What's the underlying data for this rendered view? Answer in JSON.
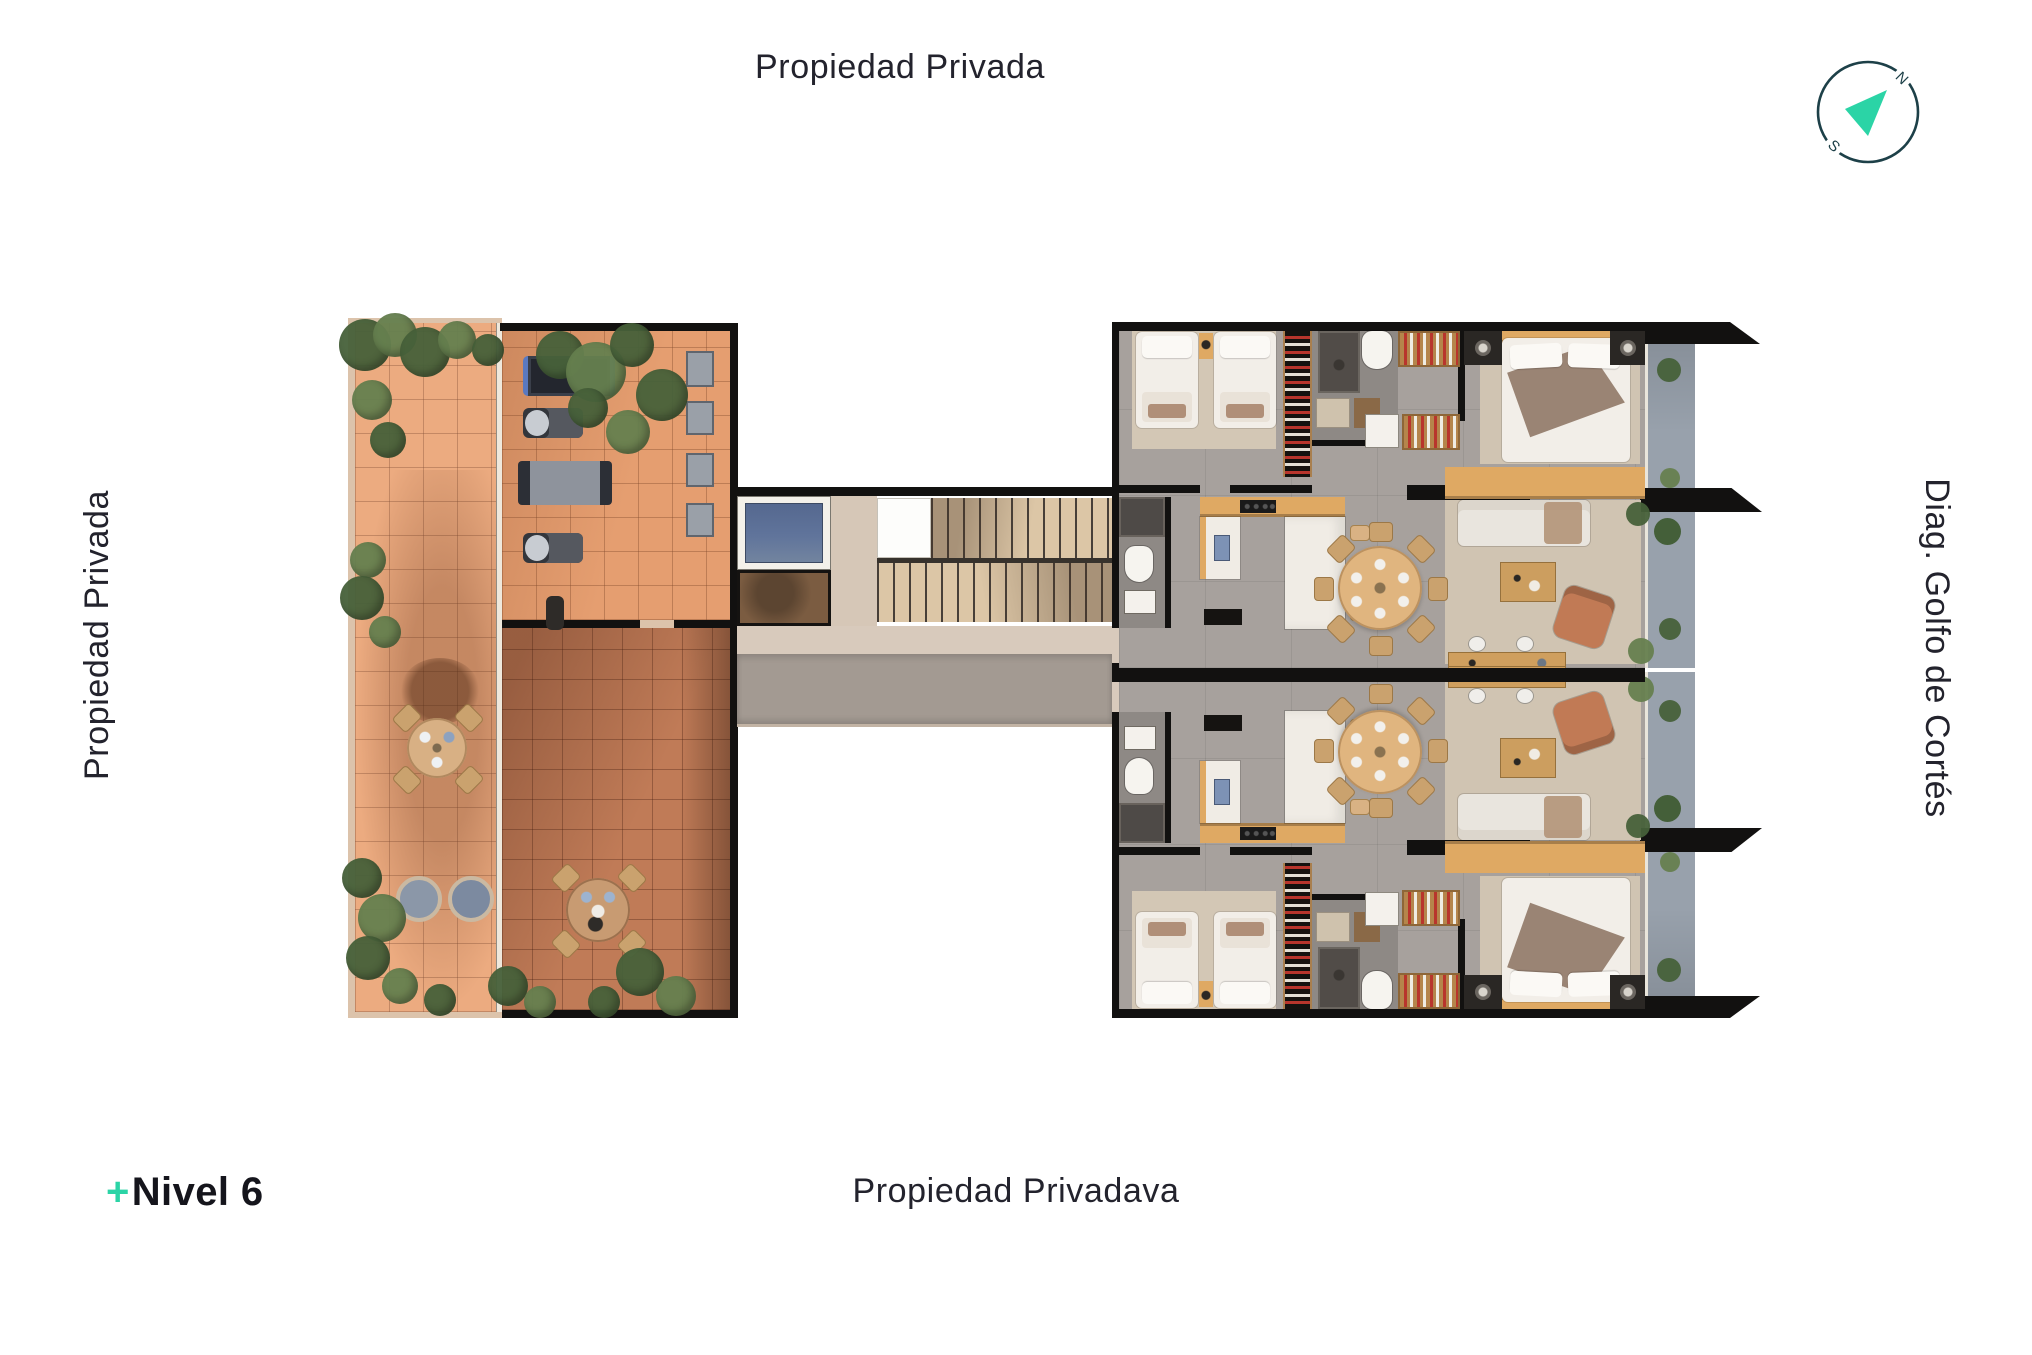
{
  "labels": {
    "top": "Propiedad Privada",
    "left": "Propiedad Privada",
    "right": "Diag. Golfo de Cortés",
    "bottom": "Propiedad Privadava"
  },
  "level_indicator": {
    "plus": "+",
    "label": "Nivel 6"
  },
  "compass": {
    "north_label": "N",
    "south_label": "S"
  },
  "palette": {
    "accent_teal": "#2bd4a6",
    "ring_navy": "#1d4048",
    "text_dark": "#23232d",
    "wall": "#121110",
    "terrace_tile": "#ecab80",
    "gym_tile": "#e59e70",
    "patio_tile": "#c07b57",
    "plant_dark": "#47613a",
    "plant_light": "#66804f",
    "unit_floor": "#a7a19d",
    "unit_floor_dark": "#8e8985",
    "rug": "#d0c4b2",
    "wood": "#dfa963",
    "wood_light": "#e0b57f",
    "white_furn": "#f0ece5",
    "corridor": "#d8cabc",
    "runner": "#a39a92",
    "stairs": "#dcc6a6",
    "elevator": "#60749b",
    "balcony": "#98a1ac",
    "shaft_brown": "#7b5c41",
    "leather": "#c17a55",
    "closet_red": "#b8352c",
    "edge_beige": "#dcc3ab"
  }
}
